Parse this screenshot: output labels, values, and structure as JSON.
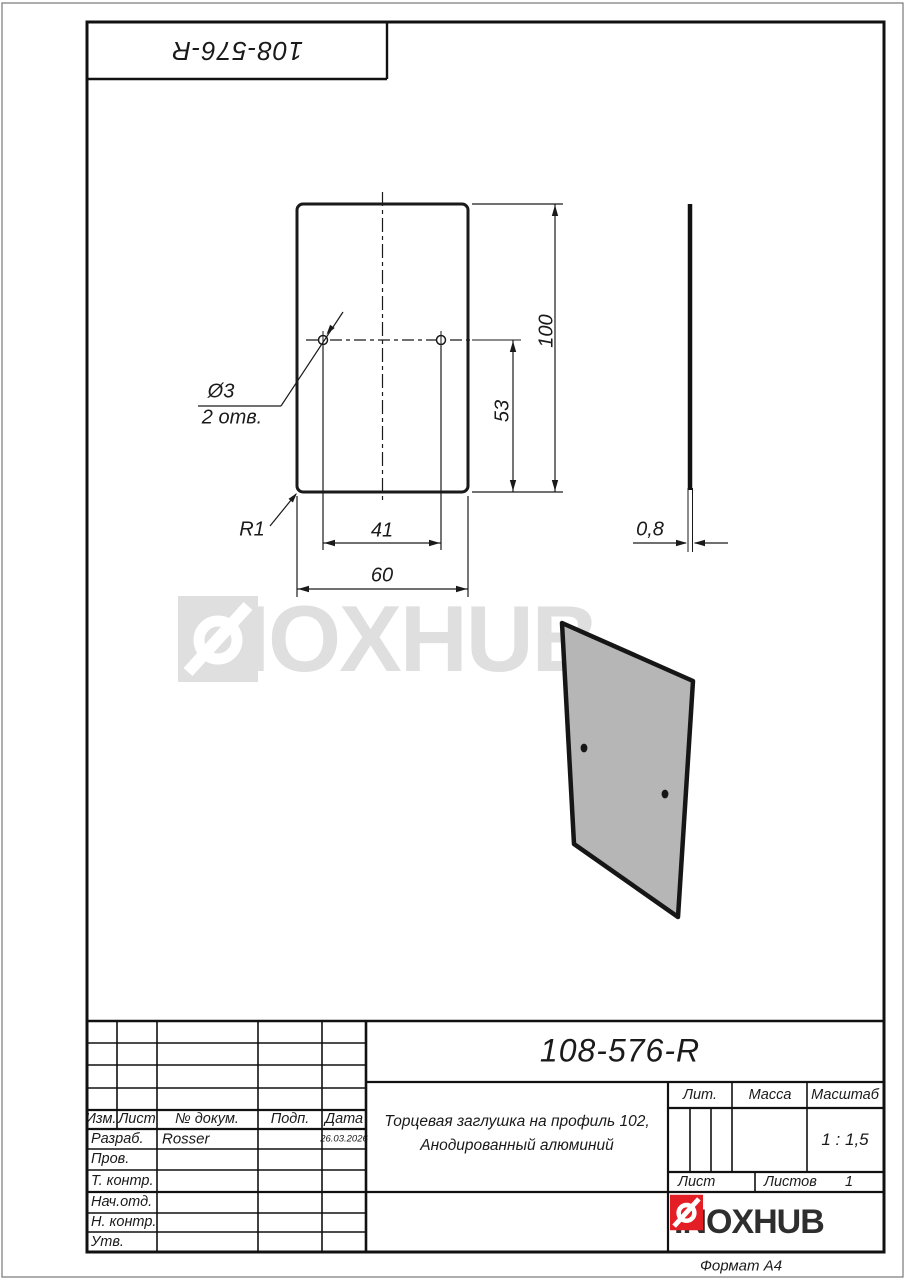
{
  "page": {
    "format_label": "Формат А4"
  },
  "frame": {
    "top_left_code": "108-576-R"
  },
  "drawing": {
    "dims": {
      "height": "100",
      "hole_offset": "53",
      "hole_spacing": "41",
      "width": "60",
      "thickness": "0,8",
      "hole_dia": "Ø3",
      "hole_count": "2 отв.",
      "corner_radius": "R1"
    }
  },
  "watermark": {
    "text": "INOXHUB"
  },
  "title_block": {
    "designation": "108-576-R",
    "description_line1": "Торцевая заглушка на профиль 102,",
    "description_line2": "Анодированный алюминий",
    "headers": {
      "izm": "Изм.",
      "sheet": "Лист",
      "doc_no": "№ докум.",
      "sign": "Подп.",
      "date": "Дата",
      "lit": "Лит.",
      "mass": "Масса",
      "scale": "Масштаб",
      "sheet2": "Лист",
      "sheets": "Листов"
    },
    "scale_value": "1 : 1,5",
    "sheets_value": "1",
    "rows": [
      {
        "label": "Разраб.",
        "name": "Rosser",
        "date": "26.03.2026"
      },
      {
        "label": "Пров.",
        "name": "",
        "date": ""
      },
      {
        "label": "Т. контр.",
        "name": "",
        "date": ""
      },
      {
        "label": "Нач.отд.",
        "name": "",
        "date": ""
      },
      {
        "label": "Н. контр.",
        "name": "",
        "date": ""
      },
      {
        "label": "Утв.",
        "name": "",
        "date": ""
      }
    ],
    "company": "INOXHUB"
  },
  "colors": {
    "accent_red": "#e31e24",
    "watermark_gray": "#dfdfdf",
    "line": "#1a1a1a",
    "part_fill": "#b6b6b6"
  }
}
